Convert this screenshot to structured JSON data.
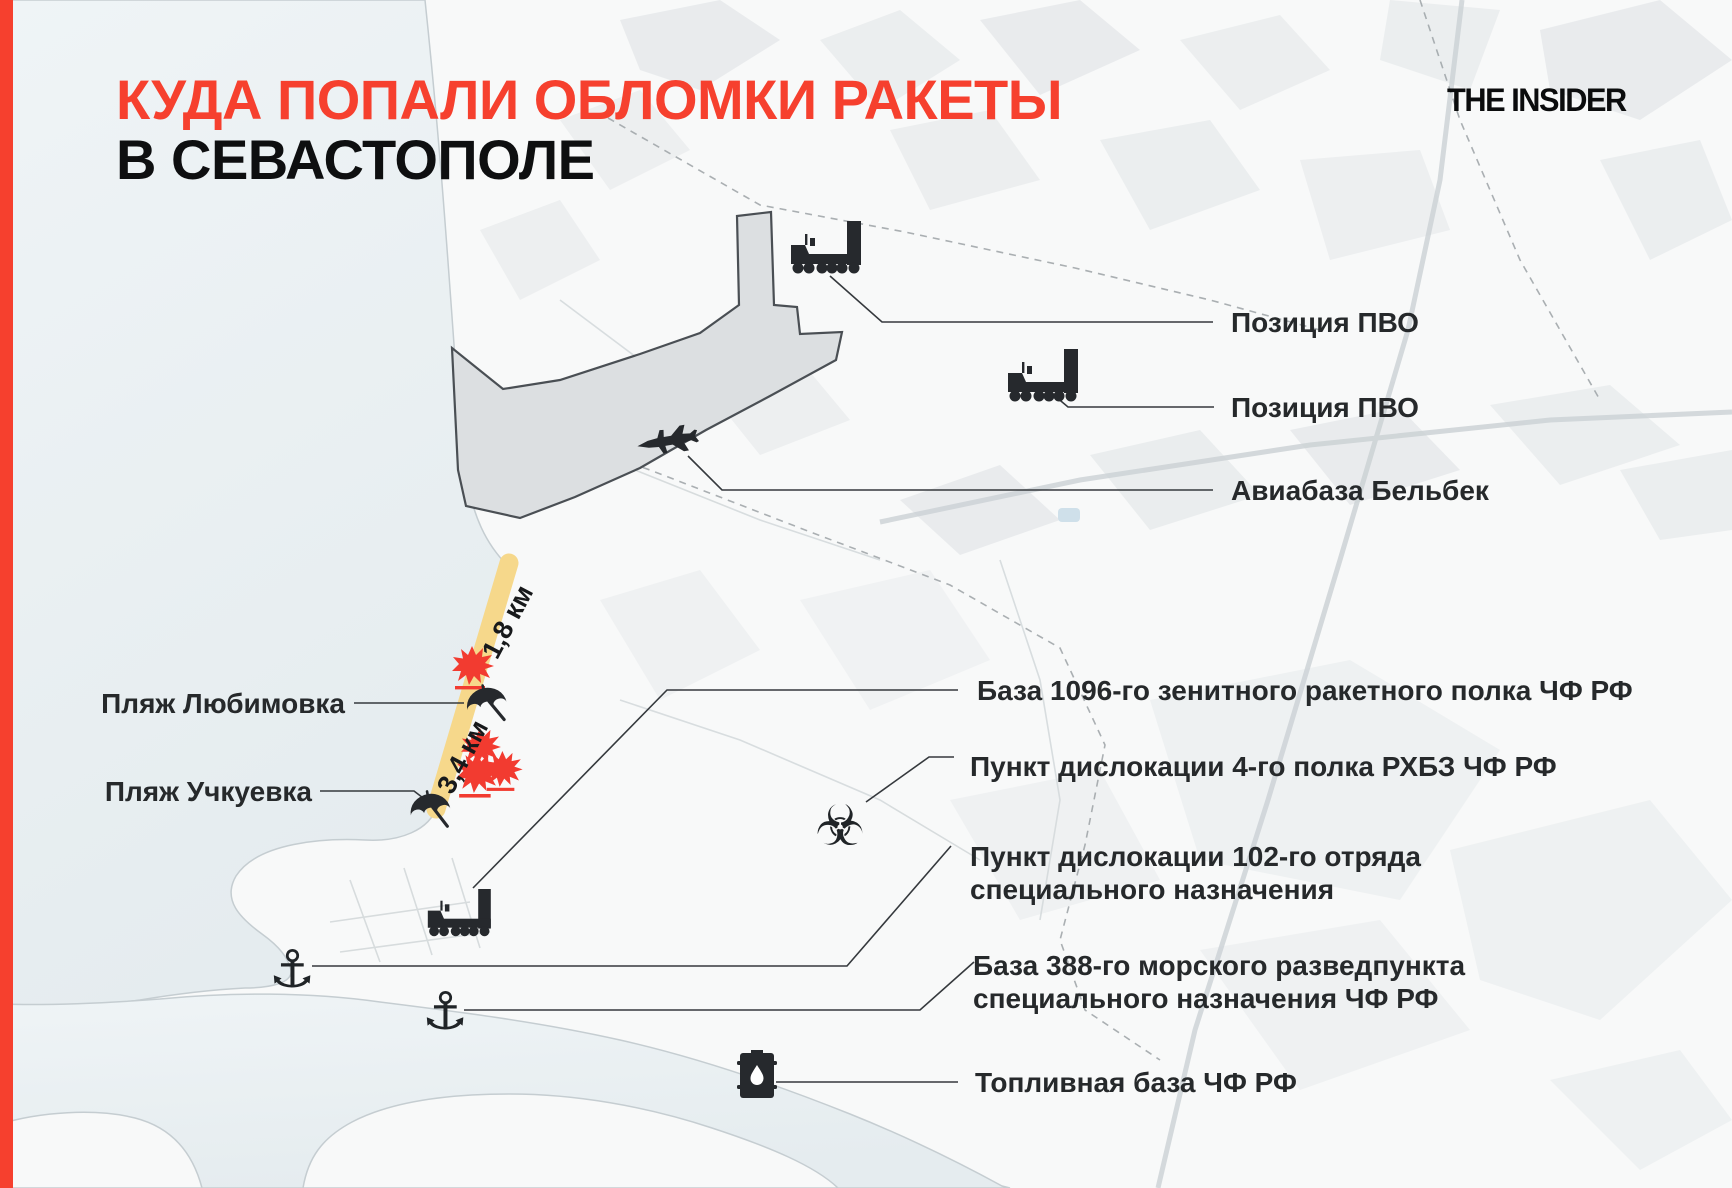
{
  "brand": {
    "logo_text": "THE INSIDER"
  },
  "title": {
    "line1": "КУДА ПОПАЛИ ОБЛОМКИ РАКЕТЫ",
    "line2": "В СЕВАСТОПОЛЕ"
  },
  "colors": {
    "accent_red": "#F6402E",
    "title_black": "#0E0F10",
    "beach_highlight_yellow": "#F6D88B",
    "explosion_red": "#F23B30",
    "sea_blue_gray": "#E9EEF1",
    "label_dark": "#26292B",
    "icon_black": "#26292D"
  },
  "map_labels": {
    "pvo_position_1": "Позиция ПВО",
    "pvo_position_2": "Позиция ПВО",
    "belbek_airbase": "Авиабаза Бельбек",
    "base_1096": "База 1096-го зенитного ракетного полка ЧФ РФ",
    "rhbz_regiment_4": "Пункт дислокации 4-го полка РХБЗ ЧФ РФ",
    "detachment_102_line1": "Пункт дислокации 102-го отряда",
    "detachment_102_line2": "специального назначения",
    "base_388_line1": "База 388-го морского разведпункта",
    "base_388_line2": "специального назначения ЧФ РФ",
    "fuel_base": "Топливная база ЧФ РФ",
    "lyubimovka_beach": "Пляж Любимовка",
    "uchkuevka_beach": "Пляж Учкуевка"
  },
  "distance_markers": {
    "lyubimovka_segment": "1,8 км",
    "uchkuevka_segment": "3,4 км"
  },
  "icons": {
    "anchor_glyph": "⚓",
    "biohazard_glyph": "☣",
    "semantic_names": [
      "sam-launcher-icon",
      "fighter-jet-icon",
      "beach-umbrella-icon",
      "explosion-icon",
      "biohazard-icon",
      "anchor-icon",
      "fuel-barrel-icon"
    ]
  }
}
